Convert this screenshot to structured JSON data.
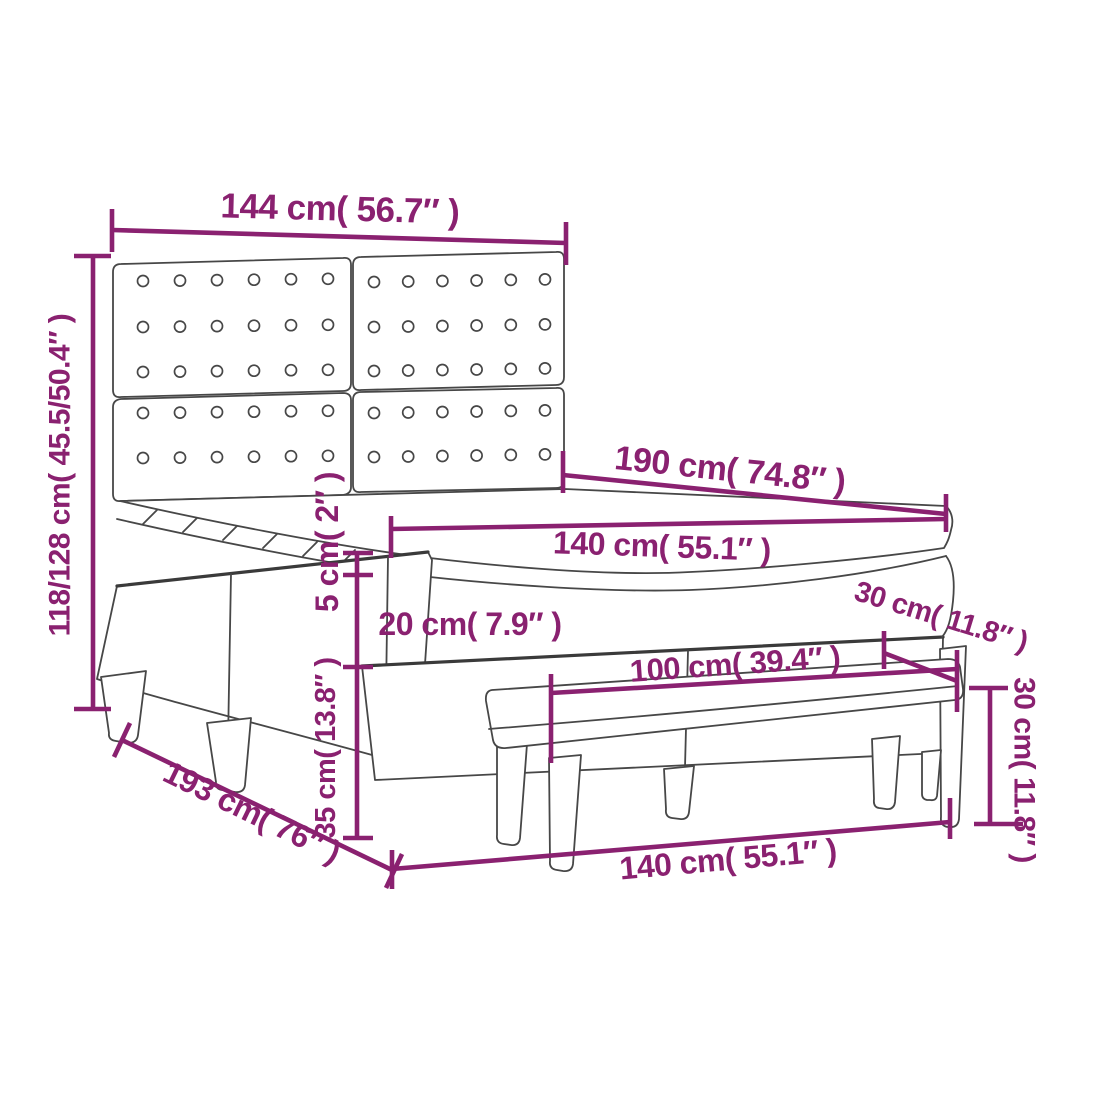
{
  "diagram": {
    "type": "furniture-dimension-diagram",
    "subject": "box spring bed with tufted headboard, mattress topper and bench",
    "background_color": "#FFFFFF",
    "accent_color": "#8A2170",
    "outline_color": "#474747",
    "labels": {
      "headboard_width": "144 cm( 56.7″ )",
      "overall_height": "118/128 cm( 45.5/50.4″ )",
      "bed_length_top": "190 cm( 74.8″ )",
      "mattress_width_top": "140 cm( 55.1″ )",
      "topper_height": "5 cm( 2″ )",
      "mattress_height": "20 cm( 7.9″ )",
      "base_height": "35 cm( 13.8″ )",
      "overall_length": "193 cm( 76″ )",
      "bench_length": "100 cm( 39.4″ )",
      "bench_depth": "30 cm( 11.8″ )",
      "bench_height": "30 cm( 11.8″ )",
      "bed_width_front": "140 cm( 55.1″ )"
    },
    "headboard_buttons": {
      "columns_per_panel": 6,
      "button_radius": 5.5,
      "panels": [
        {
          "x0": 143,
          "x1": 328,
          "rows": [
            281,
            327,
            372
          ],
          "slope": -0.012
        },
        {
          "x0": 374,
          "x1": 545,
          "rows": [
            282,
            327,
            371
          ],
          "slope": -0.015
        },
        {
          "x0": 143,
          "x1": 328,
          "rows": [
            413,
            458
          ],
          "slope": -0.012
        },
        {
          "x0": 374,
          "x1": 545,
          "rows": [
            413,
            457
          ],
          "slope": -0.015
        }
      ]
    }
  }
}
